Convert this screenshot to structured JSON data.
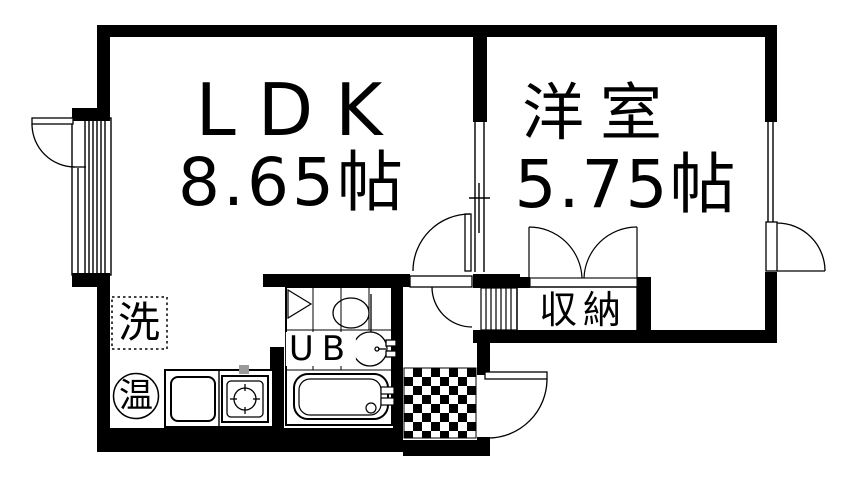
{
  "floorplan": {
    "rooms": {
      "ldk": {
        "label": "LDK",
        "size": "8.65帖"
      },
      "western_room": {
        "label": "洋室",
        "size": "5.75帖"
      },
      "storage": {
        "label": "収納"
      },
      "unit_bath": {
        "label": "UB"
      },
      "washer": {
        "label": "洗"
      },
      "water_heater": {
        "label": "温"
      }
    },
    "colors": {
      "wall": "#000000",
      "background": "#ffffff",
      "faucet_gray": "#9b9b9b"
    }
  }
}
